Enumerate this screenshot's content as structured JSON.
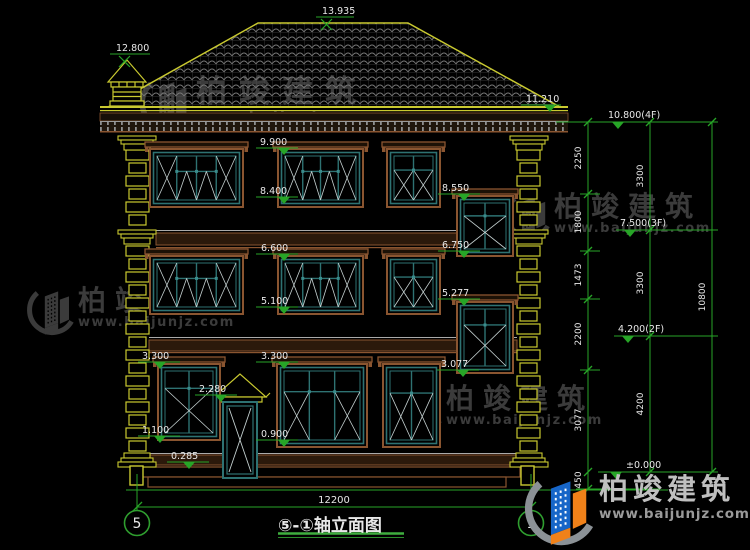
{
  "title_block": {
    "title": "⑤-①轴立面图"
  },
  "bottom_dimension": {
    "label": "12200",
    "x1": 137,
    "x2": 531,
    "y": 507,
    "label_x": 334,
    "label_y": 503
  },
  "axis_bubbles": [
    {
      "label": "5",
      "cx": 137,
      "cy": 523
    },
    {
      "label": "1",
      "cx": 531,
      "cy": 523
    }
  ],
  "brand_logo": {
    "cn": "柏竣建筑",
    "site": "www.baijunjz.com"
  },
  "watermark": {
    "cn": "柏竣建筑",
    "site": "www.baijunjz.com",
    "color": "#3b3b3b",
    "instances": [
      {
        "x": 136,
        "y": 76,
        "fs": 31,
        "ls": 12,
        "sfs": 14.5,
        "sls": 2,
        "gw": 56
      },
      {
        "x": 502,
        "y": 192,
        "fs": 28,
        "ls": 9,
        "sfs": 13,
        "sls": 1.5,
        "gw": 48
      },
      {
        "x": 24,
        "y": 286,
        "fs": 28,
        "ls": 9,
        "sfs": 13,
        "sls": 1.5,
        "gw": 50
      },
      {
        "x": 390,
        "y": 384,
        "fs": 28,
        "ls": 9,
        "sfs": 13,
        "sls": 1.5,
        "gw": 52
      }
    ]
  },
  "figure": {
    "colors": {
      "green": "#27a527",
      "yellow": "#c9c930",
      "teal": "#2e7272",
      "brown": "#8a5530",
      "white_line": "#c6d2d2",
      "text": "#e8e8e8",
      "grey_line": "#9a9a9a",
      "band_fill": "#2b190b",
      "logo_blue": "#1766c8",
      "logo_orange": "#f08119",
      "logo_swoosh": "#8b9196"
    },
    "elevation_markers": [
      {
        "t": "13.935",
        "tx": 322,
        "ty": 14,
        "lx": 316,
        "lw": 38,
        "ly": 17,
        "sx": 326,
        "sym": "x"
      },
      {
        "t": "12.800",
        "tx": 116,
        "ty": 51,
        "lx": 110,
        "lw": 40,
        "ly": 54,
        "sx": 124,
        "sym": "x"
      },
      {
        "t": "11.210",
        "tx": 526,
        "ty": 102,
        "lx": 521,
        "lw": 40,
        "ly": 105,
        "sx": 550,
        "sym": "tri"
      },
      {
        "t": "9.900",
        "tx": 260,
        "ty": 145,
        "lx": 256,
        "lw": 42,
        "ly": 148,
        "sx": 284,
        "sym": "tri"
      },
      {
        "t": "8.400",
        "tx": 260,
        "ty": 194,
        "lx": 256,
        "lw": 42,
        "ly": 197,
        "sx": 284,
        "sym": "tri"
      },
      {
        "t": "8.550",
        "tx": 442,
        "ty": 191,
        "lx": 438,
        "lw": 42,
        "ly": 194,
        "sx": 464,
        "sym": "tri"
      },
      {
        "t": "6.600",
        "tx": 261,
        "ty": 251,
        "lx": 256,
        "lw": 42,
        "ly": 254,
        "sx": 284,
        "sym": "tri"
      },
      {
        "t": "6.750",
        "tx": 442,
        "ty": 248,
        "lx": 438,
        "lw": 42,
        "ly": 251,
        "sx": 464,
        "sym": "tri"
      },
      {
        "t": "5.100",
        "tx": 261,
        "ty": 304,
        "lx": 256,
        "lw": 42,
        "ly": 307,
        "sx": 284,
        "sym": "tri"
      },
      {
        "t": "5.277",
        "tx": 442,
        "ty": 296,
        "lx": 438,
        "lw": 42,
        "ly": 299,
        "sx": 464,
        "sym": "tri"
      },
      {
        "t": "3.300",
        "tx": 142,
        "ty": 359,
        "lx": 138,
        "lw": 42,
        "ly": 362,
        "sx": 160,
        "sym": "tri"
      },
      {
        "t": "3.300",
        "tx": 261,
        "ty": 359,
        "lx": 256,
        "lw": 42,
        "ly": 362,
        "sx": 284,
        "sym": "tri"
      },
      {
        "t": "3.077",
        "tx": 441,
        "ty": 367,
        "lx": 437,
        "lw": 42,
        "ly": 370,
        "sx": 463,
        "sym": "tri"
      },
      {
        "t": "2.280",
        "tx": 199,
        "ty": 392,
        "lx": 195,
        "lw": 42,
        "ly": 395,
        "sx": 221,
        "sym": "tri"
      },
      {
        "t": "1.100",
        "tx": 142,
        "ty": 433,
        "lx": 138,
        "lw": 42,
        "ly": 436,
        "sx": 160,
        "sym": "tri"
      },
      {
        "t": "0.900",
        "tx": 261,
        "ty": 437,
        "lx": 256,
        "lw": 42,
        "ly": 440,
        "sx": 284,
        "sym": "tri"
      },
      {
        "t": "0.285",
        "tx": 171,
        "ty": 459,
        "lx": 167,
        "lw": 42,
        "ly": 462,
        "sx": 189,
        "sym": "tri"
      },
      {
        "t": "10.800(4F)",
        "tx": 608,
        "ty": 118,
        "lx": 604,
        "lw": 56,
        "ly": 122,
        "sx": 618,
        "sym": "tri"
      },
      {
        "t": "7.500(3F)",
        "tx": 620,
        "ty": 226,
        "lx": 616,
        "lw": 54,
        "ly": 230,
        "sx": 630,
        "sym": "tri"
      },
      {
        "t": "4.200(2F)",
        "tx": 618,
        "ty": 332,
        "lx": 614,
        "lw": 54,
        "ly": 336,
        "sx": 628,
        "sym": "tri"
      },
      {
        "t": "±0.000",
        "tx": 626,
        "ty": 468,
        "lx": 604,
        "lw": 56,
        "ly": 472,
        "sx": 616,
        "sym": "tri"
      }
    ],
    "dim_chains": [
      {
        "x": 588,
        "y1": 122,
        "y2": 489,
        "ticks": [
          122,
          194,
          251,
          299,
          370,
          472,
          489
        ],
        "labels": [
          {
            "t": "2250",
            "y": 158
          },
          {
            "t": "1800",
            "y": 222
          },
          {
            "t": "1473",
            "y": 275
          },
          {
            "t": "2200",
            "y": 334
          },
          {
            "t": "3077",
            "y": 420
          },
          {
            "t": "450",
            "y": 480
          }
        ]
      },
      {
        "x": 650,
        "y1": 122,
        "y2": 472,
        "ticks": [
          122,
          230,
          336,
          472
        ],
        "labels": [
          {
            "t": "3300",
            "y": 176
          },
          {
            "t": "3300",
            "y": 283
          },
          {
            "t": "4200",
            "y": 404
          }
        ]
      },
      {
        "x": 712,
        "y1": 122,
        "y2": 472,
        "ticks": [
          122,
          472
        ],
        "labels": [
          {
            "t": "10800",
            "y": 297
          }
        ]
      }
    ],
    "extensions": [
      [
        556,
        718,
        122
      ],
      [
        640,
        718,
        230
      ],
      [
        640,
        718,
        336
      ],
      [
        598,
        718,
        472
      ],
      [
        580,
        600,
        194
      ],
      [
        580,
        600,
        251
      ],
      [
        580,
        600,
        299
      ],
      [
        580,
        600,
        370
      ],
      [
        576,
        660,
        489
      ]
    ],
    "windows": [
      {
        "x": 150,
        "y": 149,
        "w": 93,
        "h": 58,
        "type": "w4"
      },
      {
        "x": 278,
        "y": 149,
        "w": 85,
        "h": 58,
        "type": "w4"
      },
      {
        "x": 387,
        "y": 149,
        "w": 53,
        "h": 58,
        "type": "w2"
      },
      {
        "x": 457,
        "y": 196,
        "w": 56,
        "h": 60,
        "type": "st"
      },
      {
        "x": 150,
        "y": 256,
        "w": 93,
        "h": 58,
        "type": "w4"
      },
      {
        "x": 278,
        "y": 256,
        "w": 85,
        "h": 58,
        "type": "w4"
      },
      {
        "x": 387,
        "y": 256,
        "w": 53,
        "h": 58,
        "type": "w2"
      },
      {
        "x": 457,
        "y": 302,
        "w": 56,
        "h": 71,
        "type": "st"
      },
      {
        "x": 158,
        "y": 364,
        "w": 62,
        "h": 76,
        "type": "st"
      },
      {
        "x": 277,
        "y": 364,
        "w": 90,
        "h": 83,
        "type": "w3"
      },
      {
        "x": 383,
        "y": 364,
        "w": 57,
        "h": 83,
        "type": "w2"
      }
    ],
    "quoins": [
      {
        "bx": 126,
        "mx": 118,
        "dx": 130
      },
      {
        "bx": 517,
        "mx": 510,
        "dx": 521
      }
    ]
  }
}
